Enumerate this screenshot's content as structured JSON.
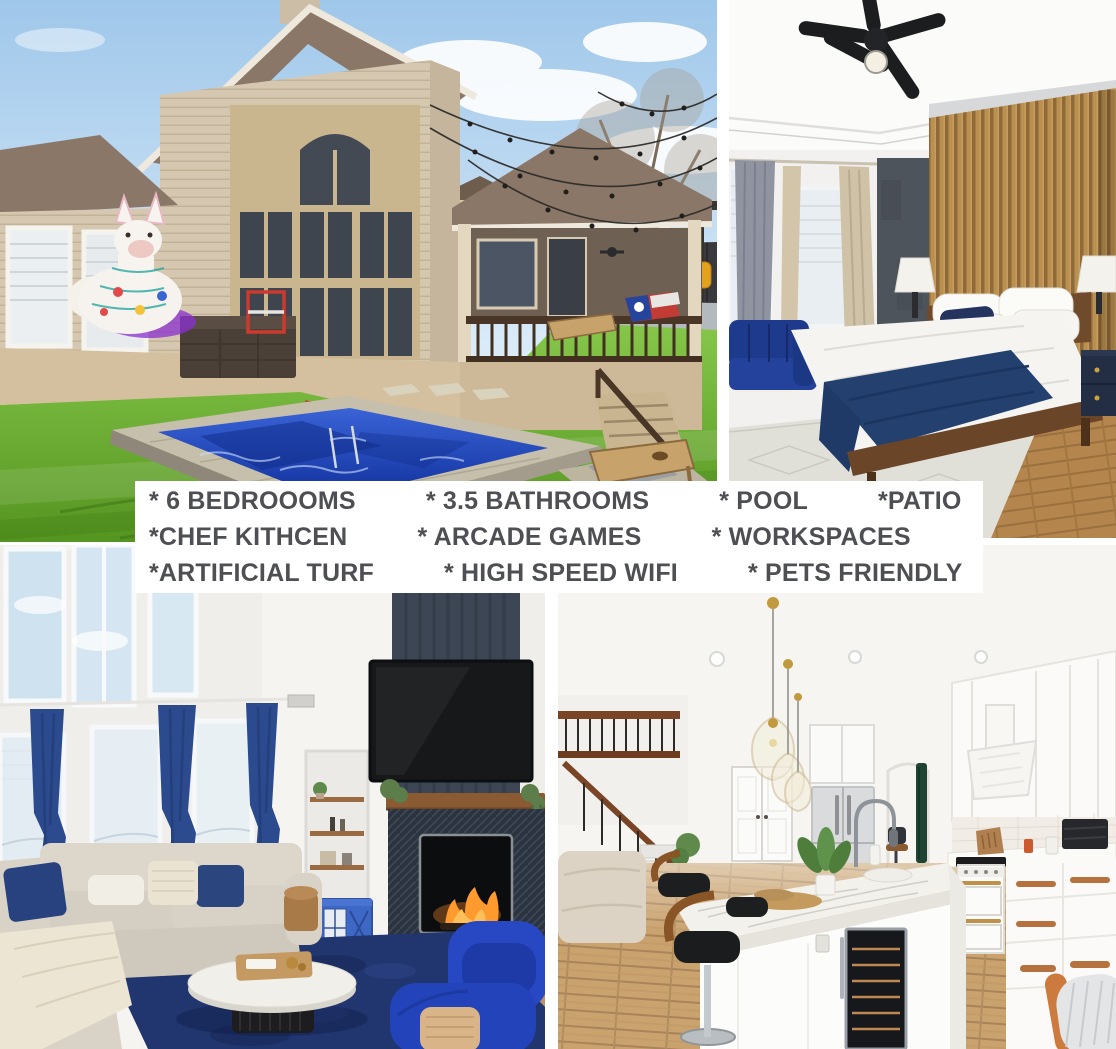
{
  "collage": {
    "background_color": "#ffffff",
    "photos": [
      {
        "label": "Backyard with pool, artificial turf, string lights, inflatable llama, cornhole boards and patio pergola"
      },
      {
        "label": "Bedroom with black ceiling fan, wood slat accent wall, navy sofa and platform bed"
      },
      {
        "label": "Living room with tall windows, navy curtains, sectional sofa, blue armchairs, TV and fireplace"
      },
      {
        "label": "Kitchen with marble island, wine fridge, bar stools, gold pendants and white cabinets"
      }
    ]
  },
  "banner": {
    "background_color": "#ffffff",
    "text_color": "#4e4f53",
    "rows": [
      {
        "items": [
          "* 6 BEDROOOMS",
          "* 3.5 BATHROOMS",
          "* POOL",
          "*PATIO"
        ]
      },
      {
        "items": [
          "*CHEF KITHCEN",
          "* ARCADE GAMES",
          "* WORKSPACES"
        ]
      },
      {
        "items": [
          "*ARTIFICIAL TURF",
          "* HIGH SPEED WIFI",
          "* PETS FRIENDLY"
        ]
      }
    ]
  },
  "palette": {
    "banner_text": "#4e4f53",
    "turf_green": "#6fb82e",
    "pool_blue": "#1e3fae",
    "accent_navy": "#24407c",
    "royal_blue": "#2747c2",
    "wood_slat": "#b9904f",
    "walnut": "#6b4628",
    "brass_gold": "#c19a3e",
    "siding_beige": "#d6c8b0",
    "yellow_chair": "#e2a21c"
  }
}
